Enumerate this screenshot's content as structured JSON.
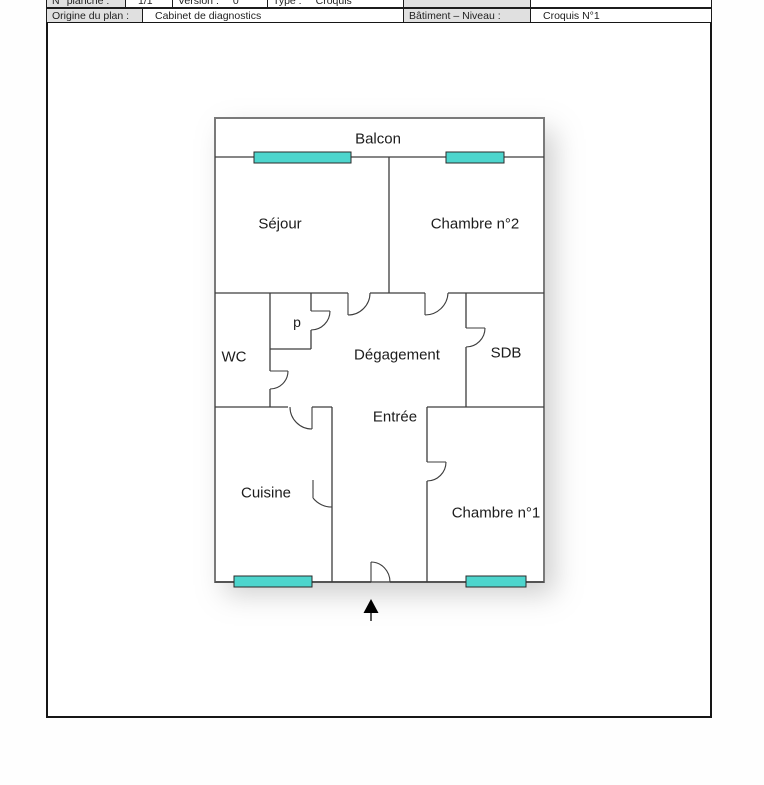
{
  "header": {
    "row1": {
      "planche_label": "N° planche :",
      "planche_value": "1/1",
      "version_label": "Version :",
      "version_value": "0",
      "type_label": "Type :",
      "type_value": "Croquis"
    },
    "row2": {
      "origin_label": "Origine du plan :",
      "origin_value": "Cabinet de diagnostics",
      "building_label": "Bâtiment – Niveau :",
      "building_value": "Croquis N°1"
    }
  },
  "plan": {
    "labels": {
      "balcon": "Balcon",
      "sejour": "Séjour",
      "chambre2": "Chambre n°2",
      "wc": "WC",
      "placard": "p",
      "degagement": "Dégagement",
      "sdb": "SDB",
      "entree": "Entrée",
      "cuisine": "Cuisine",
      "chambre1": "Chambre n°1"
    }
  },
  "colors": {
    "window_fill": "#4dd5cd",
    "wall": "#3d3d3d",
    "header_cell_bg": "#e0e0e0"
  }
}
